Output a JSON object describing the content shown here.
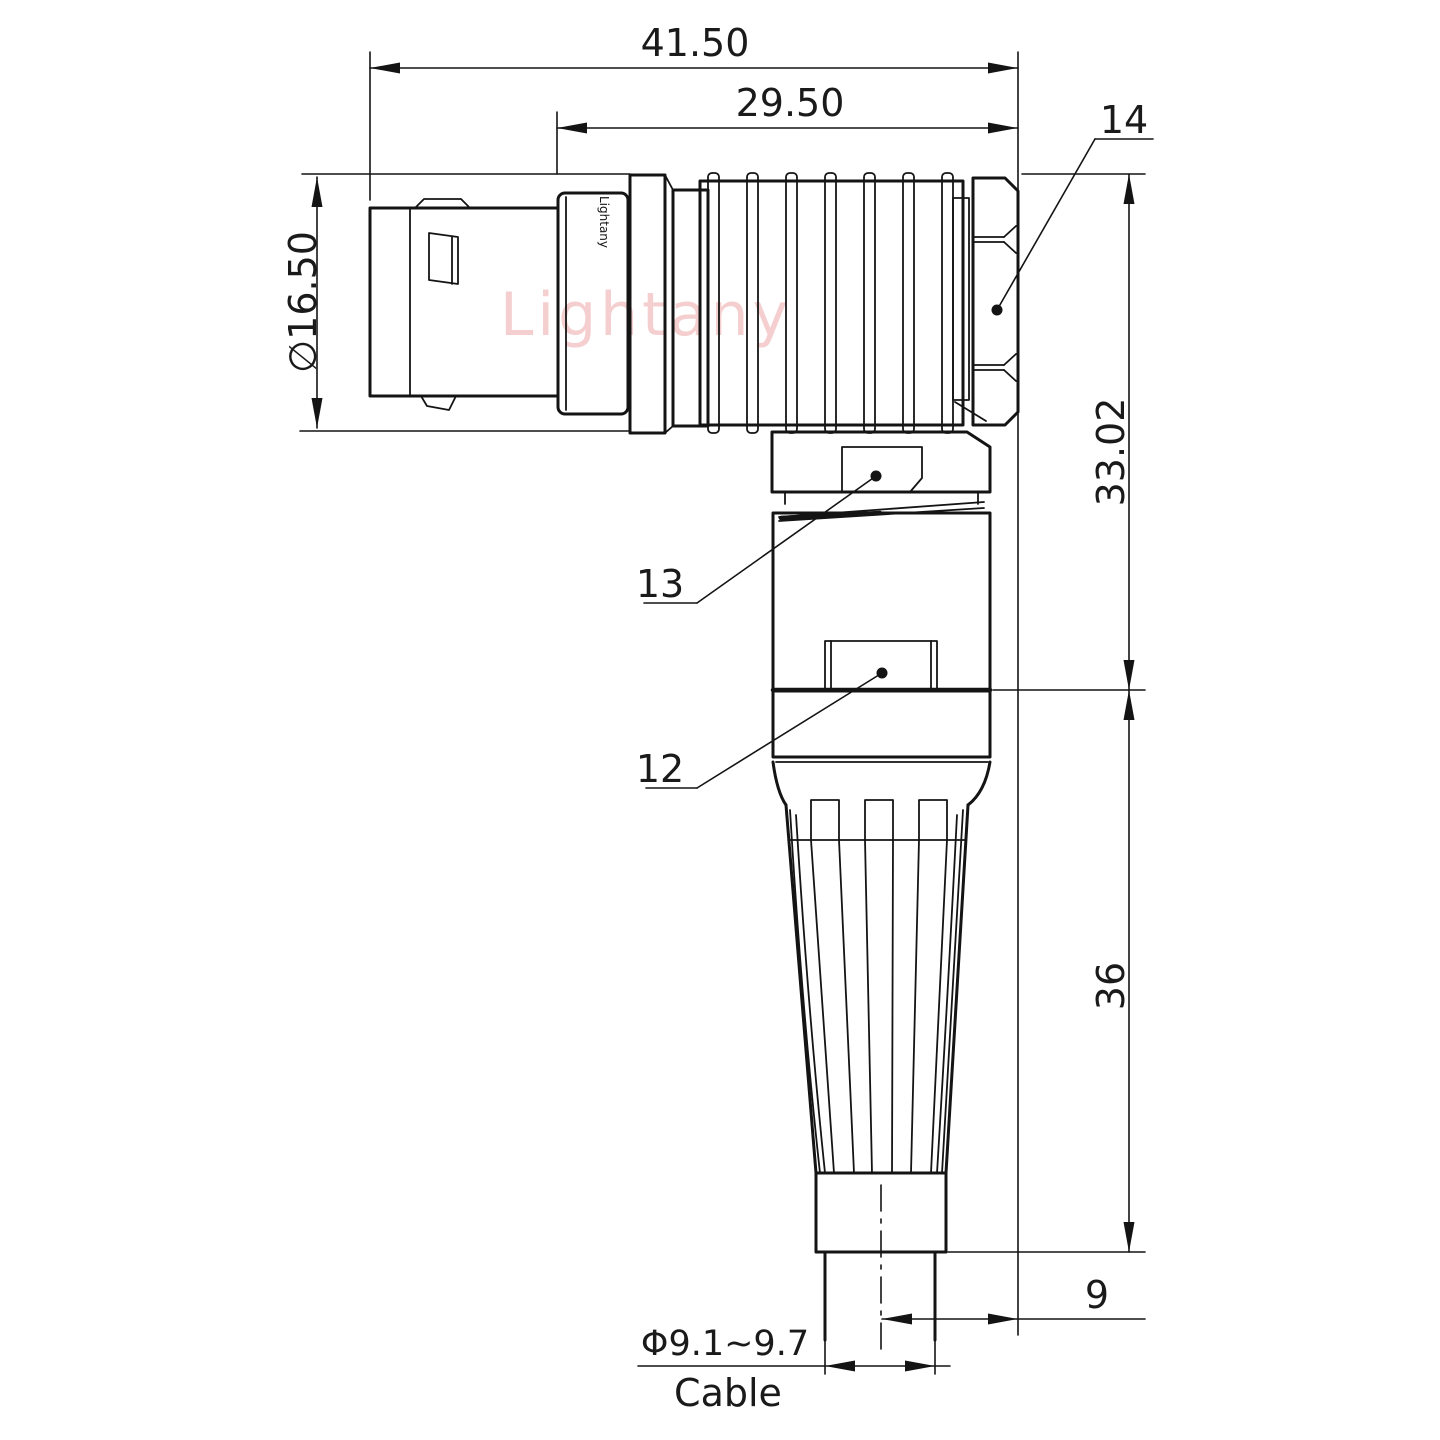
{
  "drawing": {
    "watermark": "Lightany",
    "engraving": "Lightany",
    "dimensions": {
      "overall_length": "41.50",
      "body_length": "29.50",
      "shell_diameter": "∅16.50",
      "height_upper": "33.02",
      "height_lower": "36",
      "axis_offset": "9",
      "cable_diameter": "Φ9.1~9.7",
      "cable_label": "Cable"
    },
    "part_labels": {
      "backnut": "14",
      "gland_nut": "13",
      "bushing": "12"
    },
    "colors": {
      "line": "#141414",
      "watermark": "#eda8a8",
      "background": "#ffffff"
    }
  }
}
